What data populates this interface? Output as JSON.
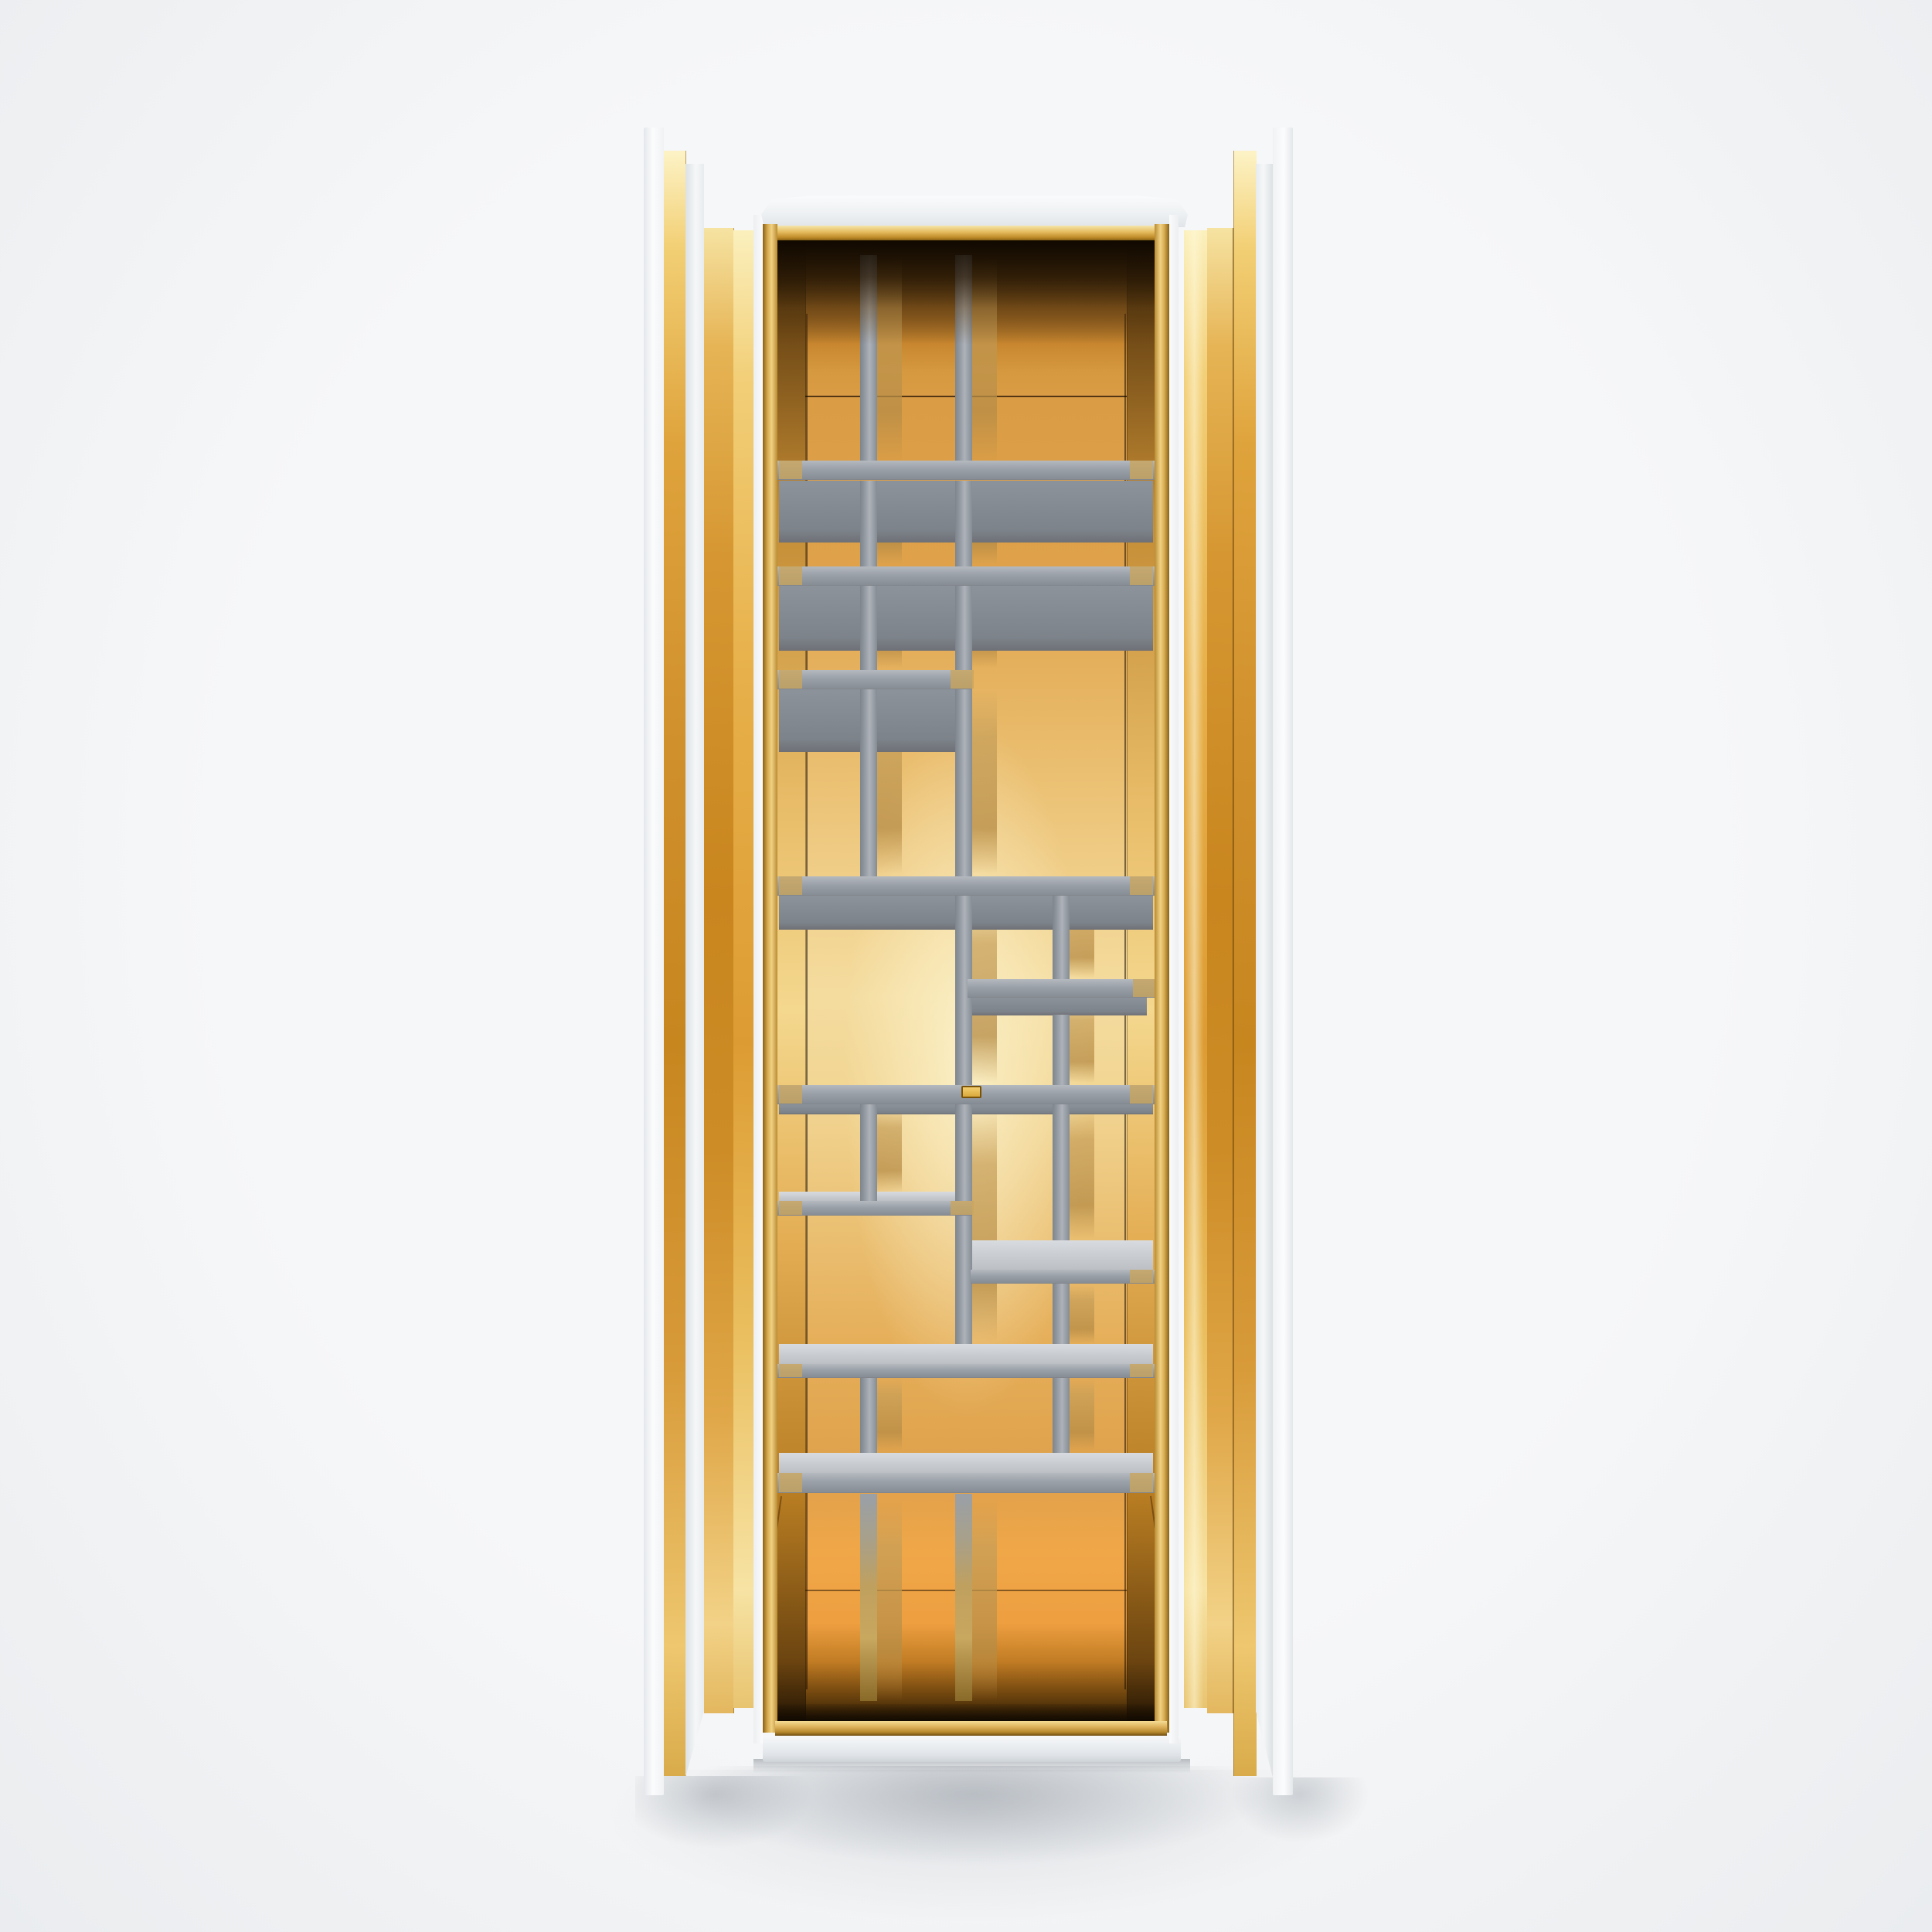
{
  "meta": {
    "type": "3d-product-render",
    "description": "Front view of a tall luxury wardrobe cabinet. Two white doors stand open, their inner faces clad in polished mirror-gold panels. The interior is gold mirror with an asymmetric Mondrian-style grid of matte gray shelves and dividers. White top cap, gold trim rails top and bottom, white plinth, soft studio background.",
    "visible_text": "none"
  },
  "scene": {
    "background_color": "#f6f7f8",
    "palette": {
      "white_panel": "#fbfcfd",
      "white_panel_shade": "#e6e9ec",
      "gold_pale": "#fbf0bd",
      "gold_bright": "#f2cf78",
      "gold_mid": "#dd9c33",
      "gold_deep": "#c8861f",
      "interior_orange": "#dfa24b",
      "interior_pale_glow": "#f5dfa3",
      "interior_shadow": "#1a0f02",
      "shelf_gray": "#9ba1a9",
      "shelf_top_gray": "#c7cbd0",
      "shelf_under_gray": "#7d838a",
      "divider_gray": "#9aa0a8",
      "reflection_tan": "#c6a05c",
      "rail_gold": "#ddb25a",
      "plinth_white": "#eceff2",
      "shadow_gray": "#8a929c",
      "logo_plaque_gold": "#e0b148",
      "logo_plaque_edge": "#7a5208"
    },
    "parts": {
      "left_door": "open door, white outside, gold mirror inner face, three beveled gold strips",
      "right_door": "open door, white outside, gold mirror inner face, three beveled gold strips",
      "top_cap": "white sloped cap with gold trim bar beneath",
      "interior": "gold mirror back and side walls with seam lines and reflections",
      "shelving": "asymmetric grid of gray shelves and vertical dividers",
      "logo_plaque": "small gold rectangular brand plaque centered on middle shelf edge",
      "base": "gold front rail over white plinth with soft floor shadow"
    },
    "shelf_rows_y": [
      596,
      733,
      867,
      1134,
      1268,
      1404,
      1546,
      1643,
      1765,
      1906
    ],
    "divider_columns_x": [
      1118,
      1241,
      1367
    ]
  }
}
